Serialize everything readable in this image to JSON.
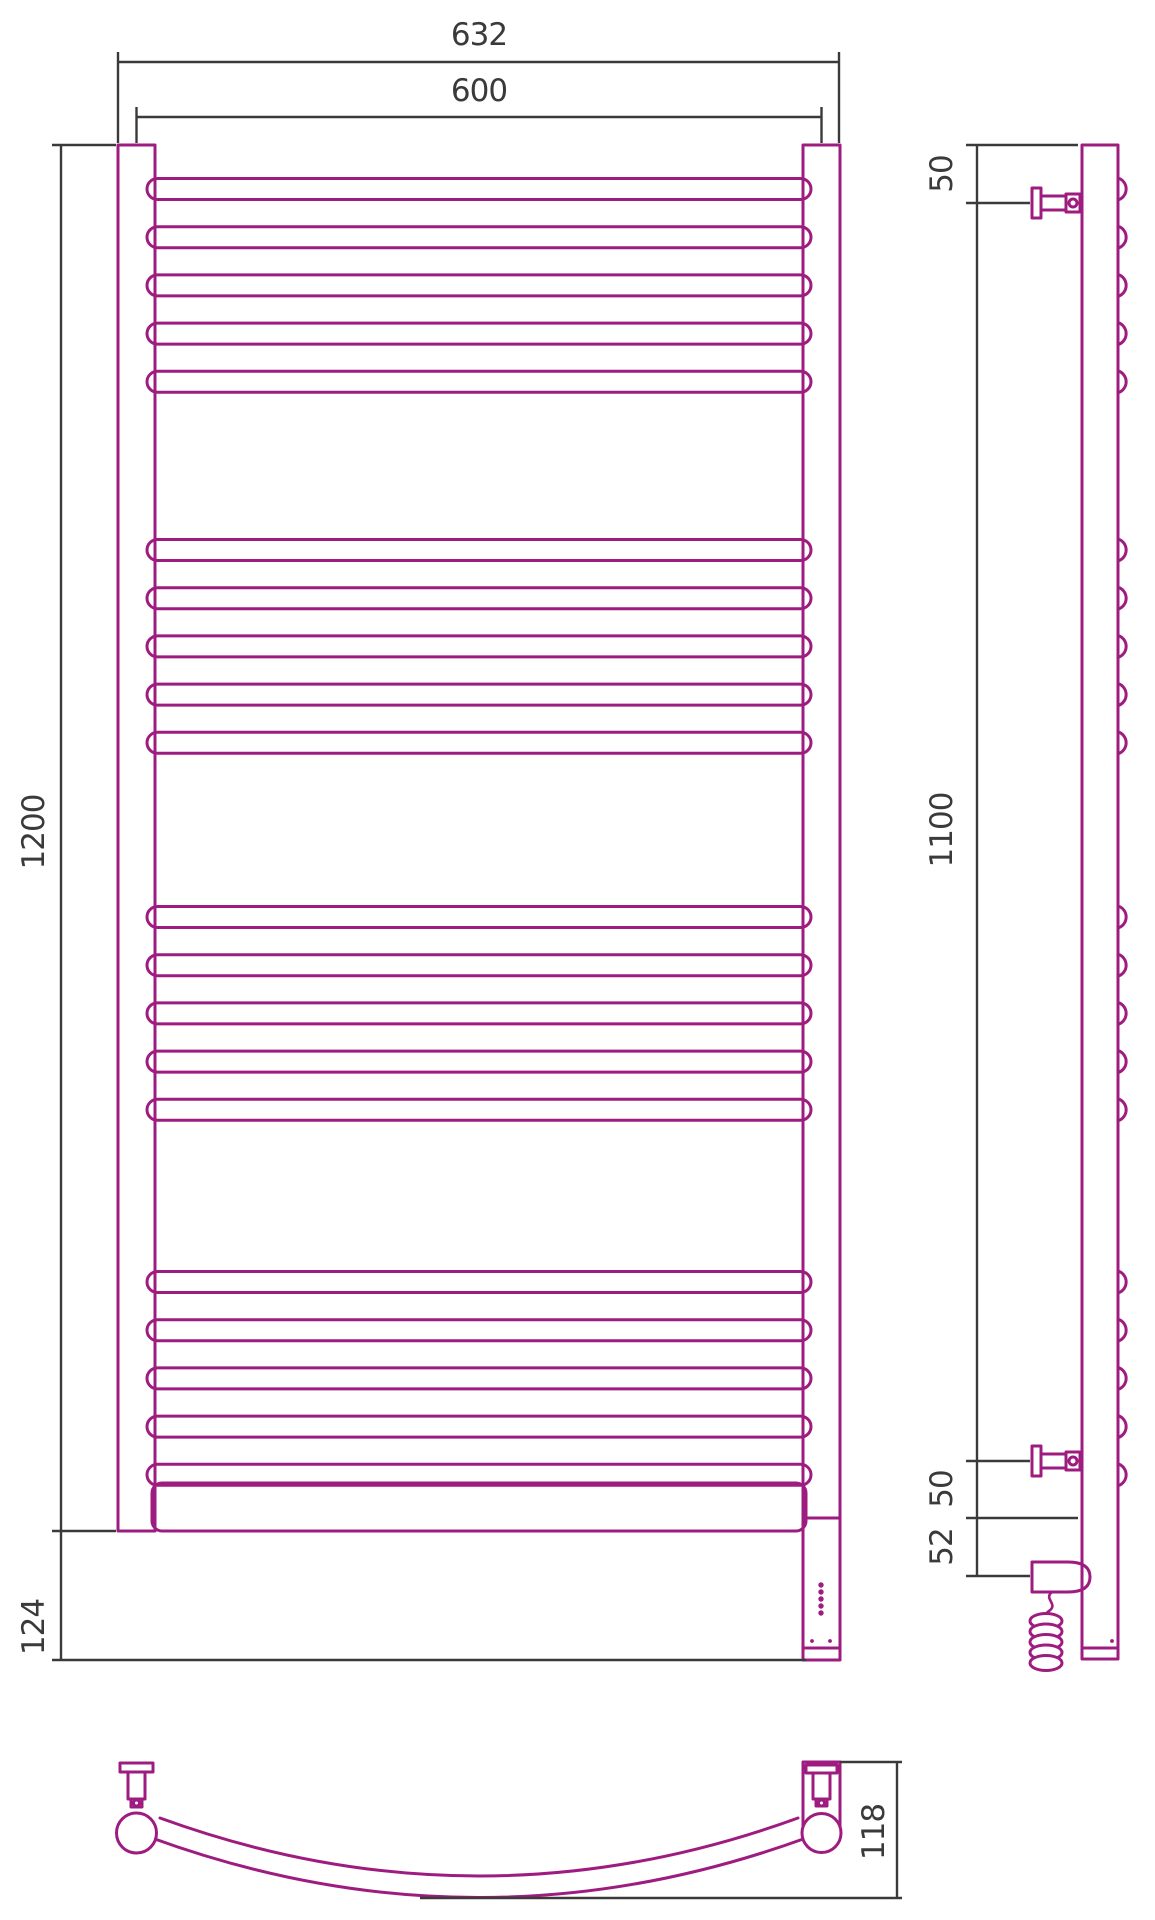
{
  "drawing": {
    "accent_color": "#9e1c80",
    "line_color": "#3a3a3a",
    "dimensions": {
      "top_outer_width": "632",
      "top_center_width": "600",
      "left_height": "1200",
      "left_bottom_height": "124",
      "side_top_offset": "50",
      "side_bracket_span": "1100",
      "side_bottom_offset": "50",
      "side_heater_offset": "52",
      "top_view_depth": "118"
    },
    "rungs": {
      "group_starts": [
        189,
        550,
        917,
        1282
      ],
      "per_group": 5,
      "pitch": 48.2,
      "height": 21
    },
    "led_dots": {
      "count": 5,
      "x": 821,
      "y_start": 1585,
      "step": 7,
      "r": 2.7
    },
    "coil": {
      "count": 5,
      "cx": 1046,
      "cy_start": 1621,
      "step": 10.5,
      "rx": 16,
      "ry": 7.5
    }
  }
}
